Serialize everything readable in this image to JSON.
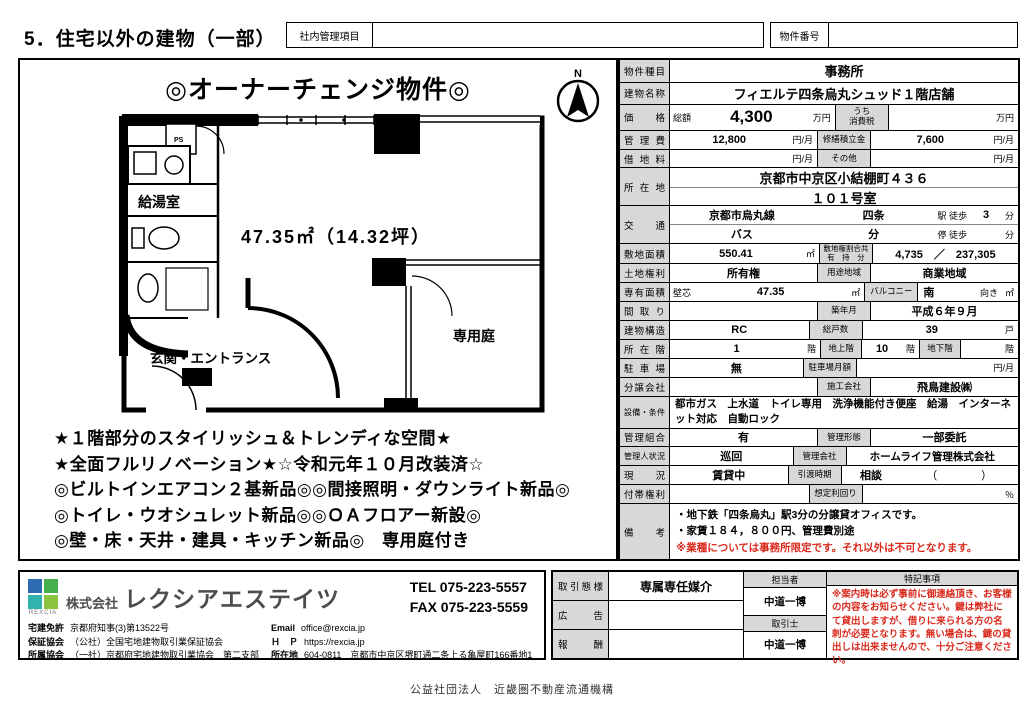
{
  "page": {
    "title": "5．住宅以外の建物（一部）",
    "internal_box_label": "社内管理項目",
    "property_no_label": "物件番号",
    "footer": "公益社団法人　近畿圏不動産流通機構"
  },
  "colors": {
    "accent_red": "#d9291c",
    "label_gray": "#d8d8d8",
    "logo_blue": "#2e6db4",
    "logo_teal": "#2fb3ae",
    "logo_green": "#45b049",
    "logo_light_green": "#8bc53f"
  },
  "plan": {
    "headline": "◎オーナーチェンジ物件◎",
    "compass_n": "N",
    "area_text": "47.35㎡（14.32坪）",
    "labels": {
      "kitchen": "給湯室",
      "ps": "PS",
      "entrance": "玄関・エントランス",
      "garden": "専用庭"
    },
    "features": [
      "★１階部分のスタイリッシュ＆トレンディな空間★",
      "★全面フルリノベーション★☆令和元年１０月改装済☆",
      "◎ビルトインエアコン２基新品◎◎間接照明・ダウンライト新品◎",
      "◎トイレ・ウオシュレット新品◎◎ＯＡフロアー新設◎",
      "◎壁・床・天井・建具・キッチン新品◎　専用庭付き"
    ]
  },
  "table": {
    "r1": {
      "label": "物件種目",
      "value": "事務所"
    },
    "r2": {
      "label": "建物名称",
      "value": "フィエルテ四条烏丸シュッド１階店舗"
    },
    "r3": {
      "label": "価格",
      "prefix": "総額",
      "value": "4,300",
      "unit": "万円",
      "mid1": "うち",
      "mid2": "消費税",
      "value2": "",
      "unit2": "万円"
    },
    "r4": {
      "label": "管理費",
      "value": "12,800",
      "unit": "円/月",
      "mid": "修繕積立金",
      "value2": "7,600",
      "unit2": "円/月"
    },
    "r5": {
      "label": "借地料",
      "value": "",
      "unit": "円/月",
      "mid": "その他",
      "value2": "",
      "unit2": "円/月"
    },
    "r6": {
      "label": "所在地",
      "line1": "京都市中京区小結棚町４３６",
      "line2": "１０１号室"
    },
    "r7": {
      "label": "交通",
      "l1a": "京都市烏丸線",
      "l1b": "四条",
      "l1c": "駅 徒歩",
      "l1d": "3",
      "l1e": "分",
      "l2a": "バス",
      "l2b": "分",
      "l2c": "停 徒歩",
      "l2e": "分"
    },
    "r8": {
      "label": "敷地面積",
      "value": "550.41",
      "unit": "㎡",
      "mid1": "敷地権割合共",
      "mid2": "有　持　分",
      "value2": "4,735　／　237,305"
    },
    "r9": {
      "label": "土地権利",
      "value": "所有権",
      "mid": "用途地域",
      "value2": "商業地域"
    },
    "r10": {
      "label": "専有面積",
      "prefix": "壁芯",
      "value": "47.35",
      "unit": "㎡",
      "mid": "バルコニー",
      "value2": "南",
      "suffix": "向き",
      "unit2": "㎡"
    },
    "r11": {
      "label": "間取り",
      "value": "",
      "mid": "築年月",
      "value2": "平成６年９月"
    },
    "r12": {
      "label": "建物構造",
      "value": "RC",
      "mid": "総戸数",
      "value2": "39",
      "unit2": "戸"
    },
    "r13": {
      "label": "所在階",
      "value": "1",
      "unit": "階",
      "mid": "地上階",
      "value2": "10",
      "unit2": "階",
      "mid2": "地下階",
      "value3": "",
      "unit3": "階"
    },
    "r14": {
      "label": "駐車場",
      "value": "無",
      "mid": "駐車場月額",
      "value2": "",
      "unit2": "円/月"
    },
    "r15": {
      "label": "分譲会社",
      "value": "",
      "mid": "施工会社",
      "value2": "飛鳥建設㈱"
    },
    "r16": {
      "label": "設備・条件",
      "value": "都市ガス　上水道　トイレ専用　洗浄機能付き便座　給湯　インターネット対応　自動ロック"
    },
    "r17": {
      "label": "管理組合",
      "value": "有",
      "mid": "管理形態",
      "value2": "一部委託"
    },
    "r18": {
      "label": "管理人状況",
      "value": "巡回",
      "mid": "管理会社",
      "value2": "ホームライフ管理株式会社"
    },
    "r19": {
      "label": "現況",
      "value": "賃貸中",
      "mid": "引渡時期",
      "value2": "相談",
      "value3": "（　　　　）"
    },
    "r20": {
      "label": "付帯権利",
      "value": "",
      "mid": "想定利回り",
      "value2": "",
      "unit2": "％"
    },
    "r21": {
      "label": "備考",
      "line1": "・地下鉄「四条烏丸」駅3分の分譲貸オフィスです。",
      "line2": "・家賃１８４，８００円、管理費別途",
      "line3": "※業種については事務所限定です。それ以外は不可となります。"
    }
  },
  "agency": {
    "logo_text": "REXCIA",
    "name_prefix": "株式会社",
    "name": "レクシアエステイツ",
    "tel": "TEL 075-223-5557",
    "fax": "FAX 075-223-5559",
    "license_label": "宅建免許",
    "license": "京都府知事(3)第13522号",
    "guarantee_label": "保証協会",
    "guarantee": "（公社）全国宅地建物取引業保証協会",
    "assoc_label": "所属協会",
    "assoc": "（一社）京都府宅地建物取引業協会　第二支部",
    "email_label": "Email",
    "email": "office@rexcia.jp",
    "hp_label": "Ｈ　Ｐ",
    "hp": "https://rexcia.jp",
    "addr_label": "所在地",
    "addr": "604-0811　京都市中京区堺町通二条上る亀屋町166番地1"
  },
  "deal": {
    "style_label": "取引態様",
    "style": "専属専任媒介",
    "ad_label": "広告",
    "ad": "",
    "fee_label": "報酬",
    "fee": "",
    "staff_label": "担当者",
    "staff": "中道一博",
    "agent_label": "取引士",
    "agent": "中道一博",
    "notes_label": "特記事項",
    "notes": "※案内時は必ず事前に御連絡頂き、お客様の内容をお知らせください。鍵は弊社にて貸出しますが、借りに来られる方の名刺が必要となります。無い場合は、鍵の貸出しは出来ませんので、十分ご注意ください。"
  }
}
